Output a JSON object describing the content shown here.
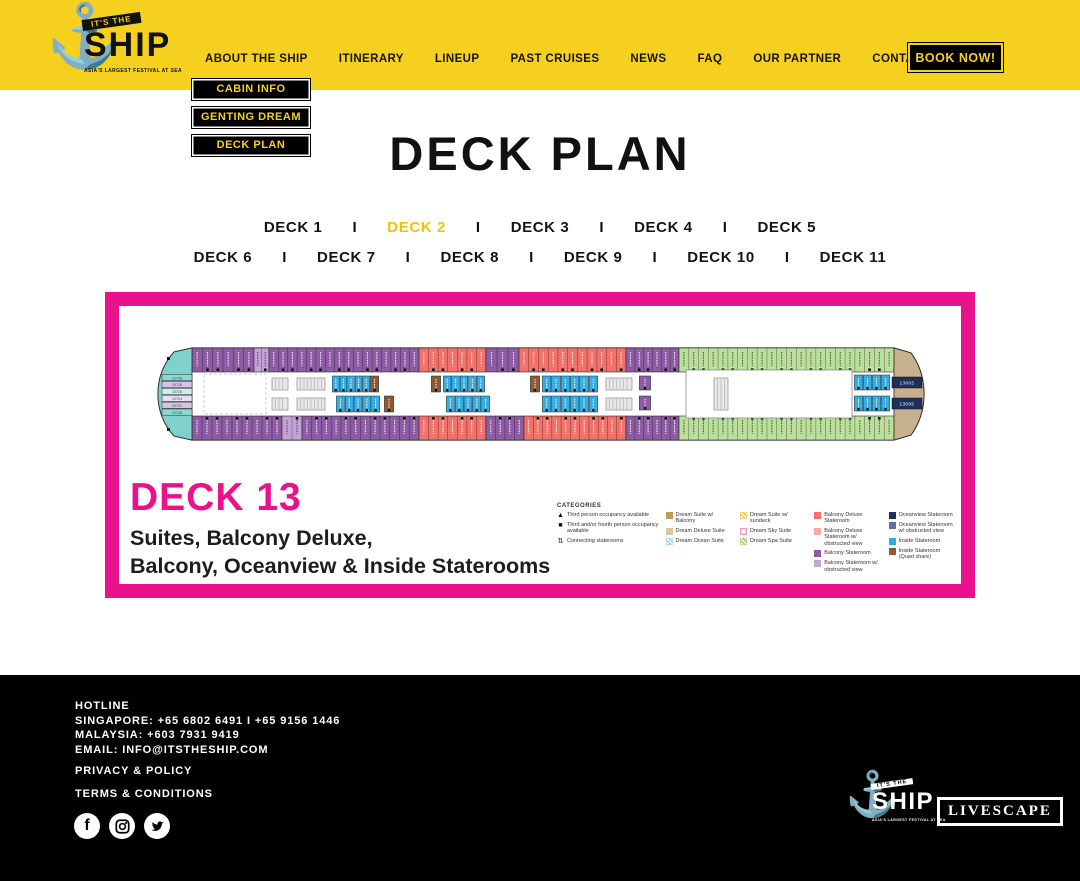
{
  "colors": {
    "accent_yellow": "#F6D01E",
    "accent_pink": "#EA118C",
    "black": "#000000"
  },
  "icons": {
    "anchor": "⚓"
  },
  "logo": {
    "top": "IT'S THE",
    "name": "SHIP",
    "tagline": "ASIA'S LARGEST FESTIVAL AT SEA"
  },
  "header": {
    "nav": [
      "ABOUT THE SHIP",
      "ITINERARY",
      "LINEUP",
      "PAST CRUISES",
      "NEWS",
      "FAQ",
      "OUR PARTNER",
      "CONTACT"
    ],
    "book_now": "BOOK NOW!"
  },
  "dropdown": {
    "items": [
      "CABIN INFO",
      "GENTING DREAM",
      "DECK PLAN"
    ]
  },
  "page": {
    "title": "DECK PLAN"
  },
  "deck_nav": {
    "separator": "I",
    "active": "DECK 2",
    "rows": [
      [
        "DECK 1",
        "DECK 2",
        "DECK 3",
        "DECK 4",
        "DECK 5"
      ],
      [
        "DECK 6",
        "DECK 7",
        "DECK 8",
        "DECK 9",
        "DECK 10",
        "DECK 11"
      ]
    ]
  },
  "plan": {
    "deck_title": "DECK 13",
    "subtitle1": "Suites, Balcony Deluxe,",
    "subtitle2": "Balcony, Oceanview & Inside Staterooms",
    "legend": {
      "heading": "CATEGORIES",
      "columns": [
        [
          {
            "sym": "▲",
            "label": "Third person occupancy available"
          },
          {
            "sym": "■",
            "label": "Third and/or fourth person occupancy available"
          },
          {
            "sym": "⇅",
            "label": "Connecting staterooms"
          }
        ],
        [
          {
            "color": "#C19A5B",
            "label": "Dream Suite w/ Balcony"
          },
          {
            "color": "#DCC69E",
            "label": "Dream Deluxe Suite"
          },
          {
            "color": "#9FD4DE",
            "pattern": "stripes",
            "label": "Dream Ocean Suite"
          }
        ],
        [
          {
            "color": "#F2C84B",
            "pattern": "stripes",
            "label": "Dream Suite w/ sundeck"
          },
          {
            "color": "#F2A0C8",
            "pattern": "outline",
            "label": "Dream Sky Suite"
          },
          {
            "color": "#A8CF6E",
            "pattern": "stripes",
            "label": "Dream Spa Suite"
          }
        ],
        [
          {
            "color": "#F2716A",
            "label": "Balcony Deluxe Stateroom"
          },
          {
            "color": "#F7A8A0",
            "label": "Balcony Deluxe Stateroom w/ obstructed view"
          },
          {
            "color": "#8E5BA5",
            "label": "Balcony Stateroom"
          },
          {
            "color": "#BCA6D6",
            "label": "Balcony Stateroom w/ obstructed view"
          }
        ],
        [
          {
            "color": "#1C2F5D",
            "label": "Oceanview Stateroom"
          },
          {
            "color": "#5F6FA0",
            "label": "Oceanview Stateroom w/ obstructed view"
          },
          {
            "color": "#2BACE2",
            "label": "Inside Stateroom"
          },
          {
            "color": "#8E5A33",
            "label": "Inside Stateroom (Quad share)"
          }
        ]
      ]
    },
    "ship": {
      "colors": {
        "purple": "#8E5BA5",
        "lightpurple": "#C3A3D6",
        "red": "#F2716A",
        "green": "#BCDF9E",
        "blue": "#35AEE4",
        "brown": "#8E5A33",
        "teal": "#7FD1CC",
        "navy": "#1C2F5D",
        "tan": "#C7B08E"
      },
      "bands": {
        "top": {
          "y": 10,
          "h": 24,
          "marker_edge": "bottom",
          "segments": [
            [
              "purple",
              38,
              62
            ],
            [
              "lightpurple",
              100,
              15
            ],
            [
              "purple",
              115,
              150
            ],
            [
              "red",
              265,
              67
            ],
            [
              "purple",
              332,
              33
            ],
            [
              "red",
              365,
              107
            ],
            [
              "purple",
              472,
              53
            ],
            [
              "green",
              525,
              215
            ]
          ]
        },
        "bottom": {
          "y": 78,
          "h": 24,
          "marker_edge": "top",
          "segments": [
            [
              "purple",
              38,
              90
            ],
            [
              "lightpurple",
              128,
              20
            ],
            [
              "purple",
              148,
              117
            ],
            [
              "red",
              265,
              67
            ],
            [
              "purple",
              332,
              38
            ],
            [
              "red",
              370,
              102
            ],
            [
              "purple",
              472,
              53
            ],
            [
              "green",
              525,
              215
            ]
          ]
        }
      },
      "bow_rows": [
        "15730",
        "15728",
        "15726",
        "15724",
        "15722",
        "15720"
      ],
      "stern_labels": [
        "13003",
        "13005"
      ],
      "clusters": [
        [
          "dashed",
          50,
          36,
          62,
          40
        ],
        [
          "stairs",
          118,
          40,
          16,
          12
        ],
        [
          "stairs",
          118,
          60,
          16,
          12
        ],
        [
          "stairs",
          143,
          40,
          28,
          12
        ],
        [
          "stairs",
          143,
          60,
          28,
          12
        ],
        [
          "blue",
          178,
          38,
          38,
          16,
          5
        ],
        [
          "brown",
          216,
          38,
          9,
          16,
          1
        ],
        [
          "blue",
          182,
          58,
          44,
          16,
          5
        ],
        [
          "brown",
          230,
          58,
          10,
          16,
          1
        ],
        [
          "brown",
          277,
          38,
          10,
          16,
          1
        ],
        [
          "blue",
          289,
          38,
          42,
          16,
          5
        ],
        [
          "blue",
          292,
          58,
          44,
          16,
          5
        ],
        [
          "brown",
          376,
          38,
          10,
          16,
          1
        ],
        [
          "blue",
          388,
          38,
          56,
          16,
          6
        ],
        [
          "blue",
          388,
          58,
          56,
          16,
          6
        ],
        [
          "stairs",
          452,
          40,
          26,
          12
        ],
        [
          "stairs",
          452,
          60,
          26,
          12
        ],
        [
          "purple",
          485,
          38,
          12,
          14,
          1
        ],
        [
          "purple",
          485,
          58,
          12,
          14,
          1
        ],
        [
          "venue",
          532,
          32,
          166,
          48
        ],
        [
          "stairs",
          560,
          40,
          14,
          32
        ],
        [
          "blue",
          700,
          37,
          36,
          15,
          4
        ],
        [
          "blue",
          700,
          58,
          36,
          15,
          4
        ]
      ]
    }
  },
  "footer": {
    "hotline_label": "HOTLINE",
    "sg": "SINGAPORE: +65 6802 6491 I +65 9156 1446",
    "my": "MALAYSIA: +603 7931 9419",
    "email": "EMAIL: INFO@ITSTHESHIP.COM",
    "privacy": "PRIVACY & POLICY",
    "terms": "TERMS & CONDITIONS",
    "facebook_glyph": "f",
    "livescape": "LIVESCAPE"
  }
}
